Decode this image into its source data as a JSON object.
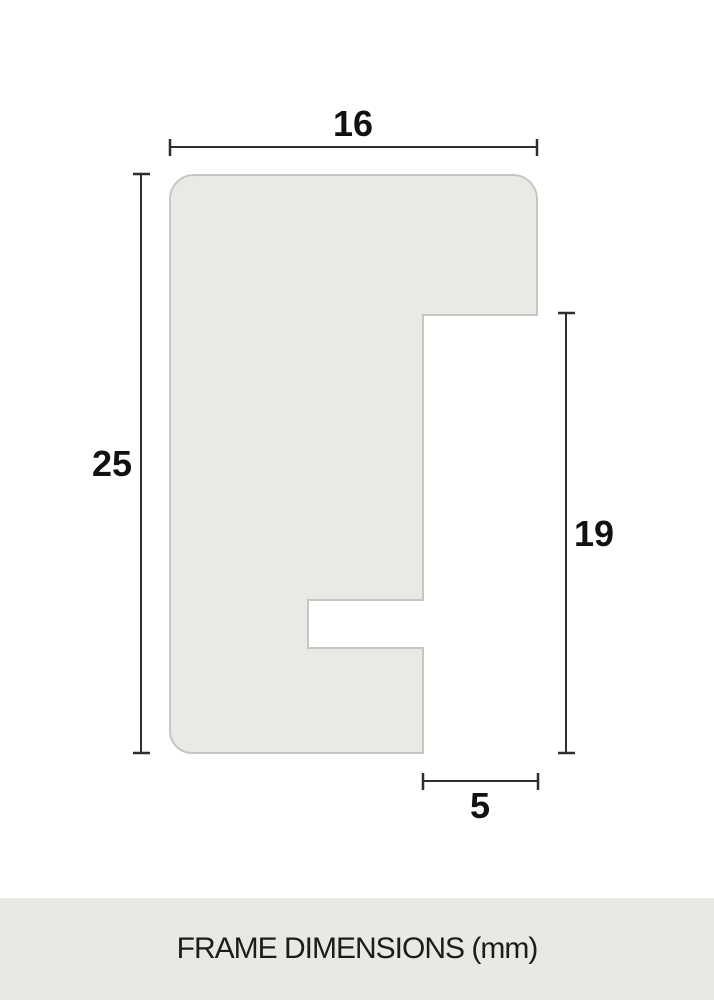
{
  "diagram": {
    "name": "frame-profile-cross-section",
    "unit": "mm",
    "dimensions": {
      "width": {
        "label": "16",
        "position": "top",
        "orientation": "horizontal"
      },
      "height": {
        "label": "25",
        "position": "left",
        "orientation": "vertical"
      },
      "rabbet_height": {
        "label": "19",
        "position": "right",
        "orientation": "vertical"
      },
      "rabbet_depth": {
        "label": "5",
        "position": "bottom",
        "orientation": "horizontal"
      }
    }
  },
  "footer": {
    "label": "FRAME DIMENSIONS (mm)"
  },
  "colors": {
    "canvas_bg": "#ffffff",
    "shape_fill": "#e9e9e5",
    "shape_stroke": "#c7c7c2",
    "dim_line": "#2e2e2e",
    "label_text": "#111111",
    "footer_bg": "#e8e8e4",
    "footer_text": "#1c1c1c"
  }
}
